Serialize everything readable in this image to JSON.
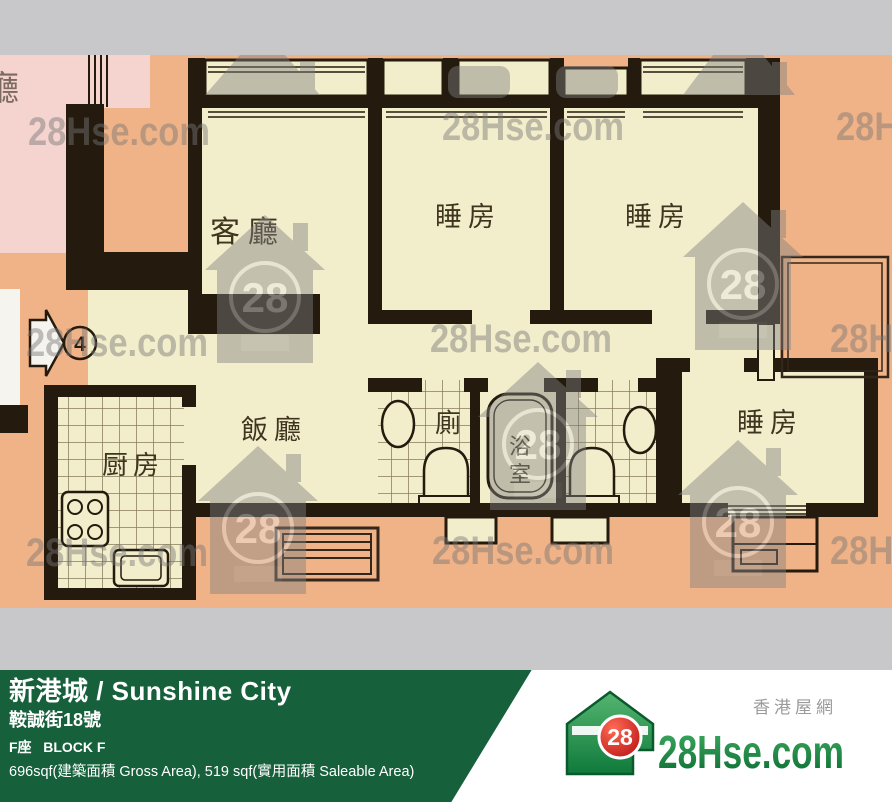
{
  "watermark": {
    "text": "28Hse.com",
    "badge": "28"
  },
  "plan": {
    "adjacent_label": "廳",
    "entrance_number": "4",
    "labels": {
      "living": "客廳",
      "bedroom": "睡房",
      "dining": "飯廳",
      "kitchen": "厨房",
      "toilet": "廁",
      "bath_char1": "浴",
      "bath_char2": "室"
    }
  },
  "footer": {
    "estate_name": "新港城 / Sunshine City",
    "address": "鞍誠街18號",
    "block": "F座   BLOCK F",
    "area": "696sqf(建築面積 Gross Area), 519 sqf(實用面積 Saleable Area)",
    "site_name": "香港屋網",
    "brand": "28Hse.com",
    "brand_badge": "28"
  },
  "colors": {
    "footer_green": "#17603c",
    "peach": "#f0b287",
    "cream": "#f2edca",
    "pink": "#f5d3cf",
    "wall": "#241a0e",
    "brand_green": "#1e8a4c",
    "badge_red": "#cc1616"
  }
}
